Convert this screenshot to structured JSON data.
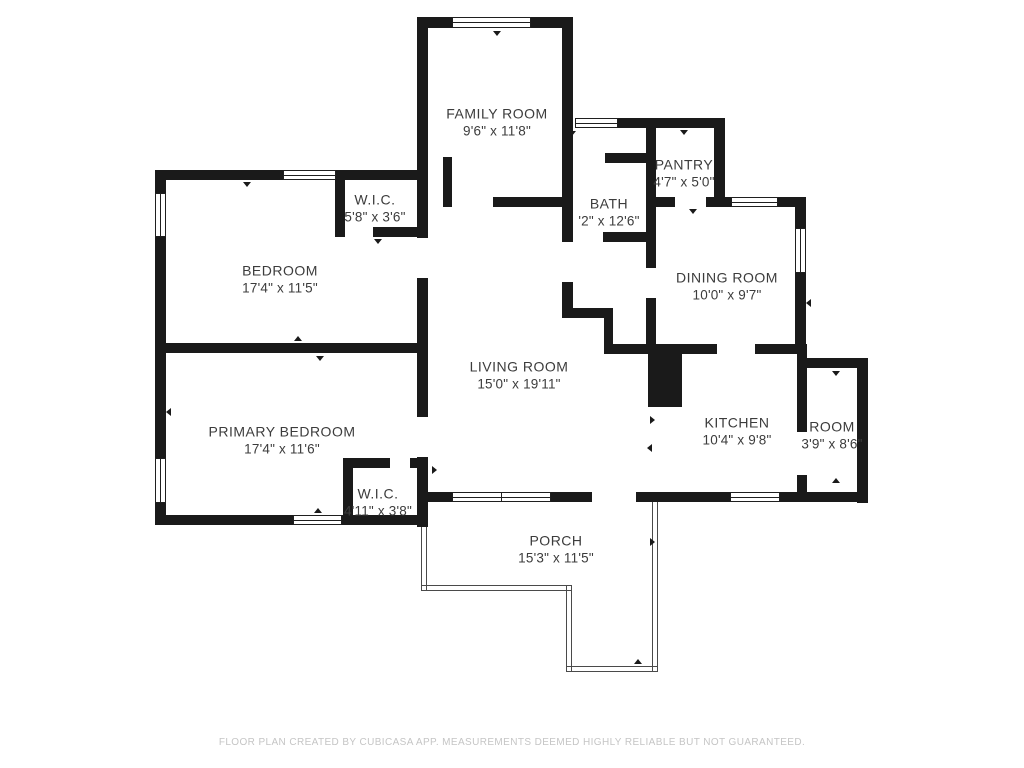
{
  "footer": {
    "disclaimer": "FLOOR PLAN CREATED BY CUBICASA APP. MEASUREMENTS DEEMED HIGHLY RELIABLE BUT NOT GUARANTEED."
  },
  "colors": {
    "wall": "#1a1a1a",
    "label_text": "#3c3c3c",
    "porch_line": "#4a4a4a",
    "footer_text": "#c5c5c5",
    "background": "#ffffff"
  },
  "floorplan": {
    "rooms": [
      {
        "name": "FAMILY ROOM",
        "dims": "9'6\" x 11'8\"",
        "cx": 497,
        "cy": 122
      },
      {
        "name": "PANTRY",
        "dims": "4'7\" x 5'0\"",
        "cx": 684,
        "cy": 173
      },
      {
        "name": "BATH",
        "dims": "'2\" x 12'6\"",
        "cx": 609,
        "cy": 212
      },
      {
        "name": "W.I.C.",
        "dims": "5'8\" x 3'6\"",
        "cx": 375,
        "cy": 208
      },
      {
        "name": "BEDROOM",
        "dims": "17'4\" x 11'5\"",
        "cx": 280,
        "cy": 279
      },
      {
        "name": "DINING ROOM",
        "dims": "10'0\" x 9'7\"",
        "cx": 727,
        "cy": 286
      },
      {
        "name": "LIVING ROOM",
        "dims": "15'0\" x 19'11\"",
        "cx": 519,
        "cy": 375
      },
      {
        "name": "PRIMARY BEDROOM",
        "dims": "17'4\" x 11'6\"",
        "cx": 282,
        "cy": 440
      },
      {
        "name": "KITCHEN",
        "dims": "10'4\" x 9'8\"",
        "cx": 737,
        "cy": 431
      },
      {
        "name": "ROOM",
        "dims": "3'9\" x 8'6\"",
        "cx": 832,
        "cy": 435
      },
      {
        "name": "W.I.C.",
        "dims": "4'11\" x 3'8\"",
        "cx": 378,
        "cy": 502
      },
      {
        "name": "PORCH",
        "dims": "15'3\" x 11'5\"",
        "cx": 556,
        "cy": 549
      }
    ],
    "walls": [
      [
        417,
        17,
        36,
        11
      ],
      [
        530,
        17,
        43,
        11
      ],
      [
        417,
        17,
        11,
        221
      ],
      [
        417,
        278,
        11,
        139
      ],
      [
        417,
        457,
        11,
        70
      ],
      [
        562,
        17,
        11,
        110
      ],
      [
        443,
        157,
        9,
        50
      ],
      [
        493,
        197,
        74,
        10
      ],
      [
        616,
        118,
        109,
        10
      ],
      [
        714,
        118,
        11,
        89
      ],
      [
        562,
        127,
        11,
        115
      ],
      [
        562,
        282,
        11,
        36
      ],
      [
        562,
        308,
        51,
        10
      ],
      [
        604,
        308,
        9,
        46
      ],
      [
        604,
        344,
        113,
        10
      ],
      [
        755,
        344,
        51,
        10
      ],
      [
        648,
        345,
        34,
        62
      ],
      [
        605,
        153,
        45,
        10
      ],
      [
        603,
        232,
        47,
        10
      ],
      [
        646,
        118,
        10,
        150
      ],
      [
        646,
        298,
        10,
        47
      ],
      [
        646,
        197,
        29,
        10
      ],
      [
        706,
        197,
        19,
        10
      ],
      [
        725,
        197,
        8,
        10
      ],
      [
        776,
        197,
        30,
        10
      ],
      [
        795,
        197,
        11,
        33
      ],
      [
        795,
        271,
        11,
        83
      ],
      [
        797,
        344,
        10,
        88
      ],
      [
        797,
        475,
        10,
        20
      ],
      [
        803,
        358,
        62,
        10
      ],
      [
        857,
        358,
        11,
        145
      ],
      [
        425,
        492,
        28,
        10
      ],
      [
        549,
        492,
        43,
        10
      ],
      [
        636,
        492,
        96,
        10
      ],
      [
        778,
        492,
        90,
        10
      ],
      [
        343,
        458,
        47,
        10
      ],
      [
        410,
        458,
        18,
        10
      ],
      [
        343,
        458,
        10,
        67
      ],
      [
        158,
        515,
        137,
        10
      ],
      [
        340,
        515,
        88,
        10
      ],
      [
        155,
        170,
        11,
        25
      ],
      [
        155,
        235,
        11,
        225
      ],
      [
        155,
        501,
        11,
        24
      ],
      [
        155,
        170,
        130,
        10
      ],
      [
        334,
        170,
        94,
        10
      ],
      [
        335,
        172,
        10,
        65
      ],
      [
        335,
        227,
        8,
        10
      ],
      [
        373,
        227,
        55,
        10
      ],
      [
        158,
        343,
        270,
        10
      ]
    ],
    "windows": [
      {
        "o": "h",
        "x": 452,
        "y": 17,
        "w": 79,
        "h": 11
      },
      {
        "o": "h",
        "x": 283,
        "y": 170,
        "w": 53,
        "h": 10
      },
      {
        "o": "h",
        "x": 575,
        "y": 118,
        "w": 43,
        "h": 10
      },
      {
        "o": "h",
        "x": 731,
        "y": 197,
        "w": 47,
        "h": 10
      },
      {
        "o": "h",
        "x": 452,
        "y": 492,
        "w": 50,
        "h": 10
      },
      {
        "o": "h",
        "x": 501,
        "y": 492,
        "w": 50,
        "h": 10
      },
      {
        "o": "h",
        "x": 730,
        "y": 492,
        "w": 50,
        "h": 10
      },
      {
        "o": "h",
        "x": 293,
        "y": 515,
        "w": 49,
        "h": 10
      },
      {
        "o": "v",
        "x": 155,
        "y": 193,
        "w": 11,
        "h": 44
      },
      {
        "o": "v",
        "x": 155,
        "y": 458,
        "w": 11,
        "h": 45
      },
      {
        "o": "v",
        "x": 795,
        "y": 228,
        "w": 11,
        "h": 45
      }
    ],
    "porch_lines": [
      {
        "o": "v",
        "x": 421,
        "y": 525,
        "w": 6,
        "h": 65
      },
      {
        "o": "h",
        "x": 421,
        "y": 585,
        "w": 150,
        "h": 6
      },
      {
        "o": "v",
        "x": 566,
        "y": 585,
        "w": 6,
        "h": 87
      },
      {
        "o": "h",
        "x": 566,
        "y": 666,
        "w": 92,
        "h": 6
      },
      {
        "o": "v",
        "x": 652,
        "y": 502,
        "w": 6,
        "h": 170
      }
    ],
    "ticks": [
      {
        "x": 497,
        "y": 31,
        "d": "down"
      },
      {
        "x": 247,
        "y": 182,
        "d": "down"
      },
      {
        "x": 572,
        "y": 131,
        "d": "down"
      },
      {
        "x": 684,
        "y": 130,
        "d": "down"
      },
      {
        "x": 693,
        "y": 209,
        "d": "down"
      },
      {
        "x": 378,
        "y": 239,
        "d": "down"
      },
      {
        "x": 171,
        "y": 412,
        "d": "left"
      },
      {
        "x": 298,
        "y": 341,
        "d": "up"
      },
      {
        "x": 320,
        "y": 356,
        "d": "down"
      },
      {
        "x": 318,
        "y": 513,
        "d": "up"
      },
      {
        "x": 836,
        "y": 371,
        "d": "down"
      },
      {
        "x": 836,
        "y": 483,
        "d": "up"
      },
      {
        "x": 650,
        "y": 420,
        "d": "right"
      },
      {
        "x": 652,
        "y": 448,
        "d": "left"
      },
      {
        "x": 432,
        "y": 470,
        "d": "right"
      },
      {
        "x": 650,
        "y": 542,
        "d": "right"
      },
      {
        "x": 638,
        "y": 664,
        "d": "up"
      },
      {
        "x": 811,
        "y": 303,
        "d": "left"
      }
    ]
  }
}
